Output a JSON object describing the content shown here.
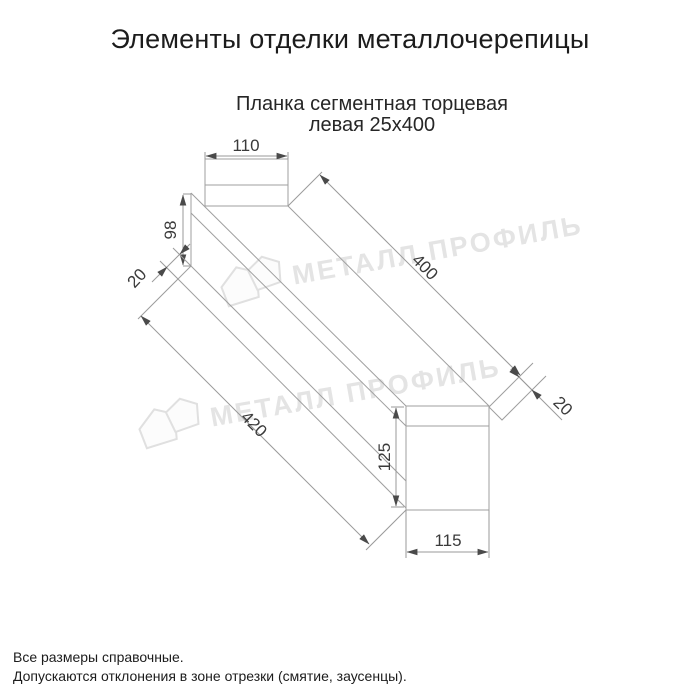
{
  "page": {
    "title": "Элементы отделки металлочерепицы",
    "subtitle": {
      "line1": "Планка сегментная торцевая",
      "line2": "левая 25х400"
    },
    "footer": {
      "line1": "Все размеры справочные.",
      "line2": "Допускаются отклонения в зоне отрезки (смятие, заусенцы)."
    }
  },
  "drawing": {
    "kind": "technical line drawing: axonometric strip with flat end profiles",
    "part": "Планка сегментная торцевая левая 25х400",
    "dims": {
      "d110": "110",
      "d98": "98",
      "d20_left": "20",
      "d400": "400",
      "d20_right": "20",
      "d420": "420",
      "d125": "125",
      "d115": "115"
    },
    "colors": {
      "background": "#ffffff",
      "outline": "#9f9f9f",
      "dim_text": "#3a3a3a",
      "arrow": "#4a4a4a",
      "heading_text": "#1c1c1c",
      "watermark": "#e4e4e4"
    }
  },
  "watermark": {
    "text": "МЕТАЛЛ ПРОФИЛЬ",
    "logo_icon": "metall-profil-logo"
  }
}
